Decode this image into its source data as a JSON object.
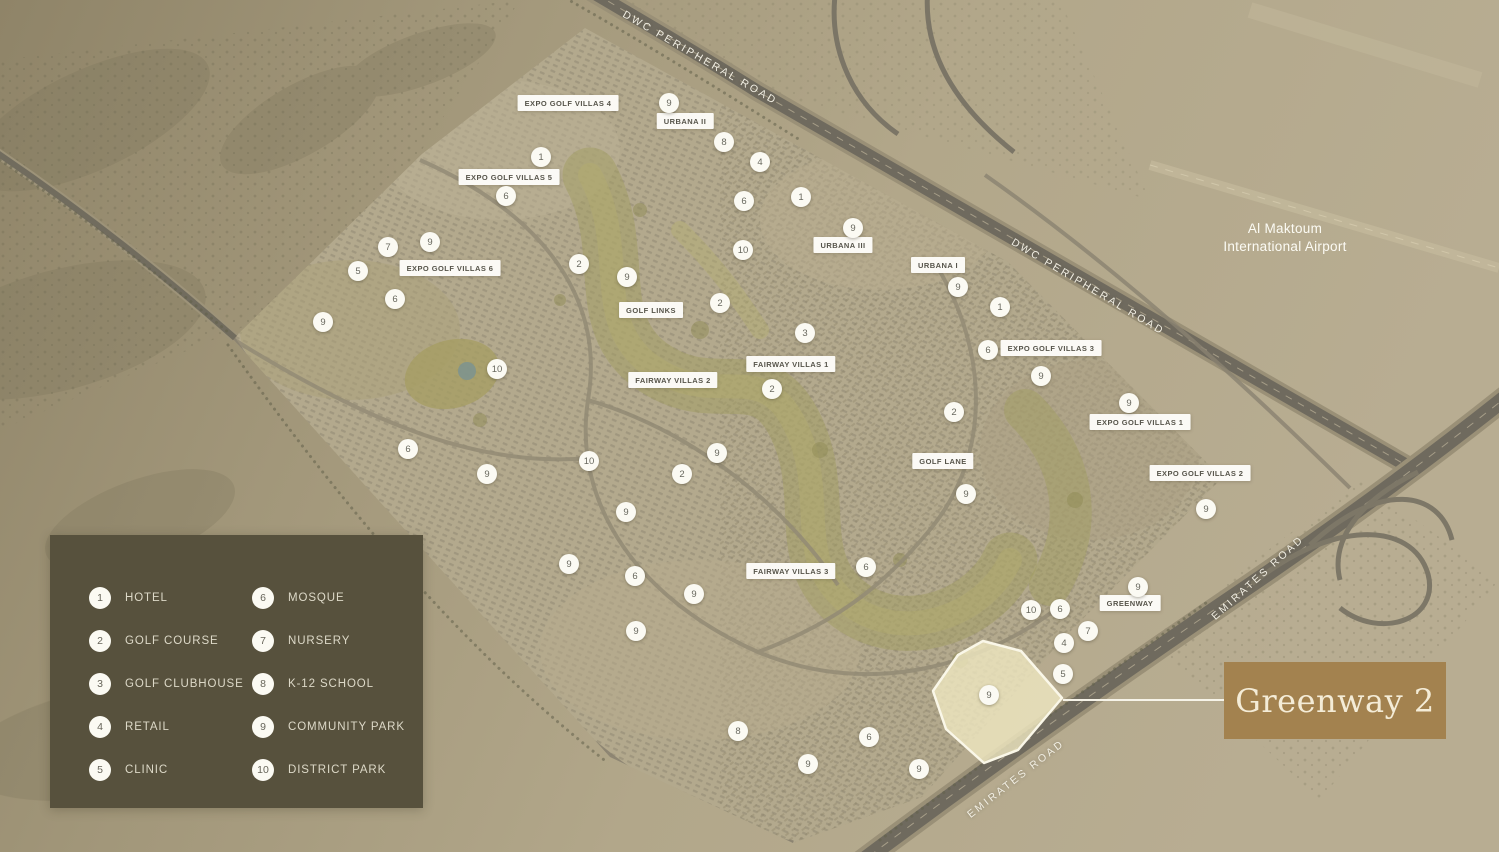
{
  "title": "Greenway 2 community master plan",
  "colors": {
    "legend_bg": "#57513d",
    "legend_text": "#ddd9c8",
    "callout_bg": "#a3824f",
    "callout_text": "#f4ecd7",
    "marker_bg": "#fbfaf3",
    "marker_text": "#68685e",
    "label_bg": "#fdfcf9",
    "label_text": "#56544a",
    "road": "#6f6a5e",
    "sand": "#b0a68a",
    "golf": "#a19c60",
    "highlight_fill": "#efe7c1",
    "highlight_stroke": "#faf7e8"
  },
  "legend": {
    "items": [
      {
        "num": "1",
        "label": "HOTEL"
      },
      {
        "num": "2",
        "label": "GOLF COURSE"
      },
      {
        "num": "3",
        "label": "GOLF CLUBHOUSE"
      },
      {
        "num": "4",
        "label": "RETAIL"
      },
      {
        "num": "5",
        "label": "CLINIC"
      },
      {
        "num": "6",
        "label": "MOSQUE"
      },
      {
        "num": "7",
        "label": "NURSERY"
      },
      {
        "num": "8",
        "label": "K-12 SCHOOL"
      },
      {
        "num": "9",
        "label": "COMMUNITY PARK"
      },
      {
        "num": "10",
        "label": "DISTRICT PARK"
      }
    ]
  },
  "callout": {
    "label": "Greenway 2"
  },
  "map": {
    "airport": {
      "line1": "Al Maktoum",
      "line2": "International Airport"
    },
    "road_labels": [
      {
        "text": "DWC PERIPHERAL ROAD",
        "x": 700,
        "y": 58,
        "angle": 30
      },
      {
        "text": "DWC PERIPHERAL ROAD",
        "x": 1088,
        "y": 287,
        "angle": 31
      },
      {
        "text": "EMIRATES ROAD",
        "x": 1258,
        "y": 578,
        "angle": -42
      },
      {
        "text": "EMIRATES ROAD",
        "x": 1016,
        "y": 779,
        "angle": -38
      }
    ],
    "area_labels": [
      {
        "text": "EXPO GOLF VILLAS 4",
        "x": 568,
        "y": 103
      },
      {
        "text": "URBANA II",
        "x": 685,
        "y": 121
      },
      {
        "text": "EXPO GOLF VILLAS 5",
        "x": 509,
        "y": 177
      },
      {
        "text": "URBANA III",
        "x": 843,
        "y": 245
      },
      {
        "text": "URBANA I",
        "x": 938,
        "y": 265
      },
      {
        "text": "EXPO GOLF VILLAS 6",
        "x": 450,
        "y": 268
      },
      {
        "text": "GOLF LINKS",
        "x": 651,
        "y": 310
      },
      {
        "text": "EXPO GOLF VILLAS 3",
        "x": 1051,
        "y": 348
      },
      {
        "text": "FAIRWAY VILLAS 1",
        "x": 791,
        "y": 364
      },
      {
        "text": "FAIRWAY VILLAS 2",
        "x": 673,
        "y": 380
      },
      {
        "text": "EXPO GOLF VILLAS 1",
        "x": 1140,
        "y": 422
      },
      {
        "text": "GOLF LANE",
        "x": 943,
        "y": 461
      },
      {
        "text": "EXPO GOLF VILLAS 2",
        "x": 1200,
        "y": 473
      },
      {
        "text": "FAIRWAY VILLAS 3",
        "x": 791,
        "y": 571
      },
      {
        "text": "GREENWAY",
        "x": 1130,
        "y": 603
      }
    ],
    "markers": [
      {
        "n": "9",
        "x": 669,
        "y": 103
      },
      {
        "n": "8",
        "x": 724,
        "y": 142
      },
      {
        "n": "1",
        "x": 541,
        "y": 157
      },
      {
        "n": "4",
        "x": 760,
        "y": 162
      },
      {
        "n": "6",
        "x": 506,
        "y": 196
      },
      {
        "n": "1",
        "x": 801,
        "y": 197
      },
      {
        "n": "6",
        "x": 744,
        "y": 201
      },
      {
        "n": "9",
        "x": 853,
        "y": 228
      },
      {
        "n": "9",
        "x": 430,
        "y": 242
      },
      {
        "n": "7",
        "x": 388,
        "y": 247
      },
      {
        "n": "10",
        "x": 743,
        "y": 250
      },
      {
        "n": "2",
        "x": 579,
        "y": 264
      },
      {
        "n": "5",
        "x": 358,
        "y": 271
      },
      {
        "n": "9",
        "x": 627,
        "y": 277
      },
      {
        "n": "9",
        "x": 958,
        "y": 287
      },
      {
        "n": "6",
        "x": 395,
        "y": 299
      },
      {
        "n": "2",
        "x": 720,
        "y": 303
      },
      {
        "n": "1",
        "x": 1000,
        "y": 307
      },
      {
        "n": "9",
        "x": 323,
        "y": 322
      },
      {
        "n": "3",
        "x": 805,
        "y": 333
      },
      {
        "n": "6",
        "x": 988,
        "y": 350
      },
      {
        "n": "10",
        "x": 497,
        "y": 369
      },
      {
        "n": "9",
        "x": 1041,
        "y": 376
      },
      {
        "n": "2",
        "x": 772,
        "y": 389
      },
      {
        "n": "9",
        "x": 1129,
        "y": 403
      },
      {
        "n": "2",
        "x": 954,
        "y": 412
      },
      {
        "n": "6",
        "x": 408,
        "y": 449
      },
      {
        "n": "9",
        "x": 717,
        "y": 453
      },
      {
        "n": "10",
        "x": 589,
        "y": 461
      },
      {
        "n": "9",
        "x": 487,
        "y": 474
      },
      {
        "n": "2",
        "x": 682,
        "y": 474
      },
      {
        "n": "9",
        "x": 966,
        "y": 494
      },
      {
        "n": "9",
        "x": 1206,
        "y": 509
      },
      {
        "n": "9",
        "x": 626,
        "y": 512
      },
      {
        "n": "9",
        "x": 569,
        "y": 564
      },
      {
        "n": "6",
        "x": 866,
        "y": 567
      },
      {
        "n": "6",
        "x": 635,
        "y": 576
      },
      {
        "n": "9",
        "x": 1138,
        "y": 587
      },
      {
        "n": "9",
        "x": 694,
        "y": 594
      },
      {
        "n": "6",
        "x": 1060,
        "y": 609
      },
      {
        "n": "10",
        "x": 1031,
        "y": 610
      },
      {
        "n": "9",
        "x": 636,
        "y": 631
      },
      {
        "n": "7",
        "x": 1088,
        "y": 631
      },
      {
        "n": "4",
        "x": 1064,
        "y": 643
      },
      {
        "n": "5",
        "x": 1063,
        "y": 674
      },
      {
        "n": "9",
        "x": 989,
        "y": 695
      },
      {
        "n": "8",
        "x": 738,
        "y": 731
      },
      {
        "n": "6",
        "x": 869,
        "y": 737
      },
      {
        "n": "9",
        "x": 808,
        "y": 764
      },
      {
        "n": "9",
        "x": 919,
        "y": 769
      }
    ]
  }
}
